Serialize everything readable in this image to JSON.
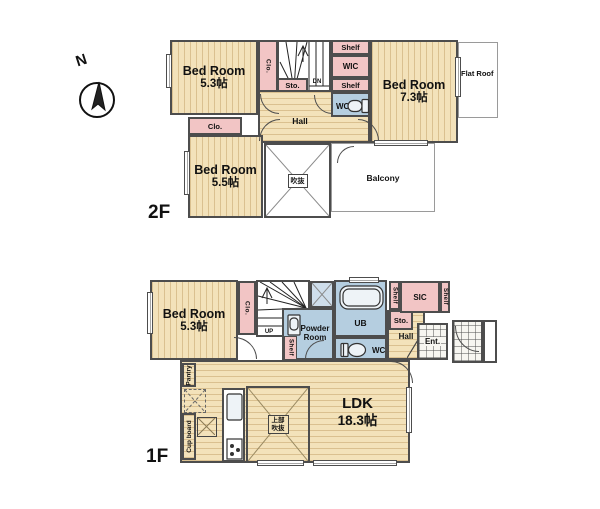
{
  "compass": {
    "label": "N"
  },
  "colors": {
    "wood": "#f3e2ba",
    "pink": "#f2c5c5",
    "blue": "#b5cee0",
    "wall": "#4d4d4d",
    "outline_thin": "#9a9a9a"
  },
  "floor2": {
    "label": "2F",
    "bedroom_a": {
      "name": "Bed Room",
      "size": "5.3帖"
    },
    "bedroom_b": {
      "name": "Bed Room",
      "size": "7.3帖"
    },
    "bedroom_c": {
      "name": "Bed Room",
      "size": "5.5帖"
    },
    "closet_stairs": "Clo.",
    "closet_b": "Clo.",
    "storage": "Sto.",
    "stairs_direction": "DN",
    "shelf_top": "Shelf",
    "wic": "WIC",
    "shelf_mid": "Shelf",
    "wc": "WC",
    "hall": "Hall",
    "void": "吹抜",
    "balcony": "Balcony",
    "flat_roof": "Flat Roof"
  },
  "floor1": {
    "label": "1F",
    "bedroom": {
      "name": "Bed Room",
      "size": "5.3帖"
    },
    "closet": "Clo.",
    "stairs_direction": "UP",
    "powder_room": {
      "line1": "Powder",
      "line2": "Room"
    },
    "shelf_powder": "Shelf",
    "bath": "UB",
    "wc": "WC",
    "shelf_sic_left": "Shelf",
    "sic": "SIC",
    "shelf_sic_right": "Shelf",
    "storage": "Sto.",
    "hall": "Hall",
    "entrance": "Ent.",
    "pantry": "Pantry",
    "cupboard": "Cup board",
    "ldk": {
      "name": "LDK",
      "size": "18.3帖"
    },
    "upper_void": {
      "line1": "上部",
      "line2": "吹抜"
    }
  }
}
